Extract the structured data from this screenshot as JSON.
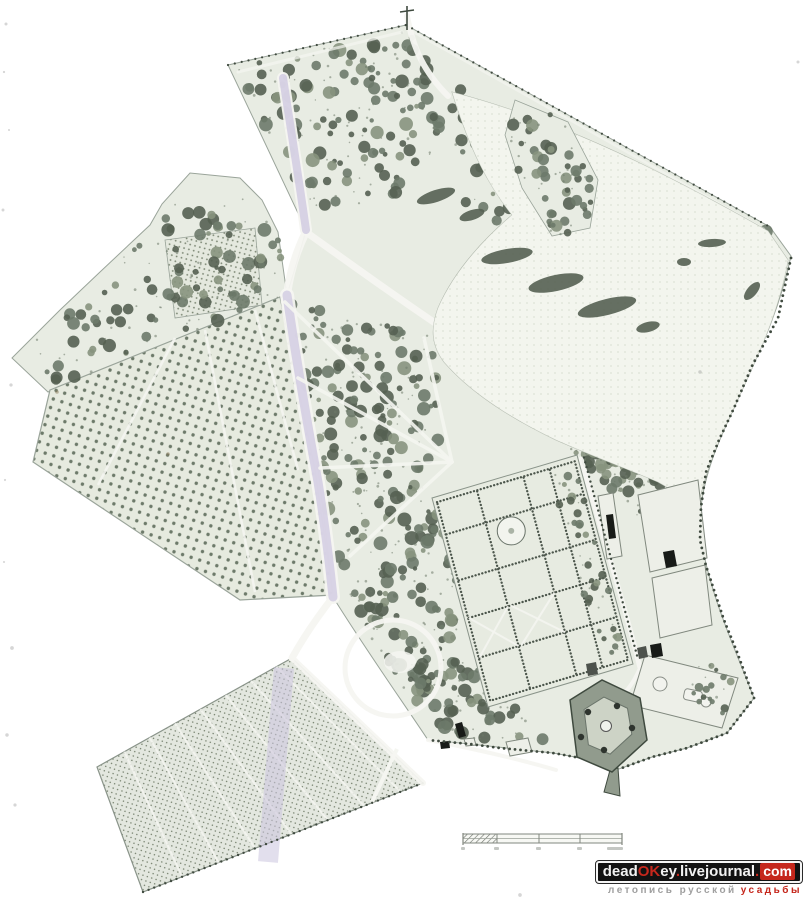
{
  "page": {
    "background": "#ffffff"
  },
  "map": {
    "kind": "scanned hand-drawn estate park plan",
    "palette": {
      "paper": "#ffffff",
      "park_base": "#e8ece3",
      "park_edge": "#9aa49a",
      "tree_dark": "#556052",
      "tree_mid": "#6d7a6a",
      "tree_light": "#87937e",
      "meadow": "#f3f5ee",
      "meadow_dot": "#dfe4d8",
      "path_white": "#f5f6f1",
      "road_lilac": "#ccc5df",
      "ink": "#3f4a3f",
      "building_dark": "#181b18",
      "building_mid": "#4d524c",
      "building_light": "#edefe8",
      "pentagon_fill": "#919b8d",
      "pentagon_inner": "#cdd3c6",
      "speck": "#8a7a5a"
    }
  },
  "scalebar": {
    "present": true,
    "segments": 4,
    "hatched_left_section": true,
    "labels_legible": false
  },
  "watermark": {
    "line1": {
      "part1": "dead",
      "part2": "OK",
      "part3": "ey",
      "dot1": ".",
      "part4": "livejournal",
      "dot2": ".",
      "part5": "com"
    },
    "line2": {
      "text_gray": "летопись русской",
      "text_red": "усадьбы"
    },
    "colors": {
      "banner_bg": "#121212",
      "banner_border": "#f5f5f5",
      "text_white": "#f2f2f2",
      "accent_red": "#c5271c",
      "sub_gray": "#9f9f9f"
    }
  }
}
